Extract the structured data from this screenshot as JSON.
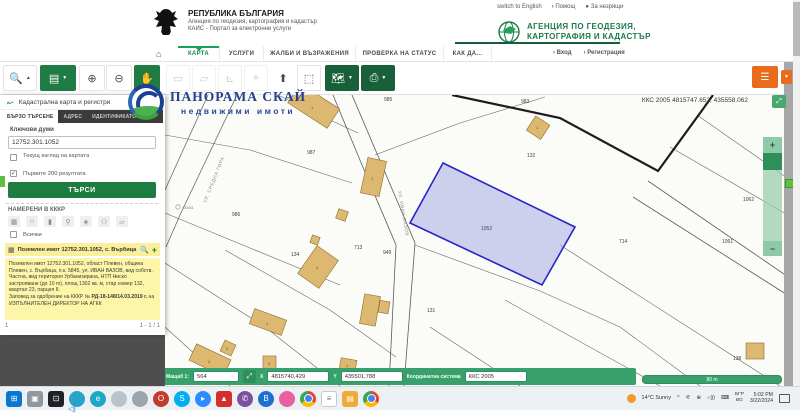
{
  "header": {
    "coat_title": "РЕПУБЛИКА БЪЛГАРИЯ",
    "coat_sub1": "Агенция по геодезия, картография и кадастър",
    "coat_sub2": "КАИС - Портал за електронни услуги",
    "top_links": {
      "english": "switch to English",
      "help": "Помощ",
      "blind": "За незрящи",
      "arrow": "›",
      "dot": "●"
    },
    "agency_line1": "АГЕНЦИЯ ПО ГЕОДЕЗИЯ,",
    "agency_line2": "КАРТОГРАФИЯ И КАДАСТЪР",
    "nav": [
      {
        "label": "КАРТА"
      },
      {
        "label": "УСЛУГИ"
      },
      {
        "label": "ЖАЛБИ И ВЪЗРАЖЕНИЯ"
      },
      {
        "label": "ПРОВЕРКА НА СТАТУС"
      },
      {
        "label": "КАК ДА..."
      }
    ],
    "auth": {
      "login": "Вход",
      "register": "Регистрация",
      "arrow": "›"
    }
  },
  "sidebar": {
    "panel_title": "Кадастрална карта и регистри",
    "tabs": [
      {
        "label": "БЪРЗО ТЪРСЕНЕ"
      },
      {
        "label": "АДРЕС"
      },
      {
        "label": "ИДЕНТИФИКАТОР"
      },
      {
        "label": "С"
      }
    ],
    "keywords_label": "Ключови думи",
    "search_value": "12752.301.1052",
    "cb_current_view": "Текущ изглед на картата",
    "cb_first_200": "Първите 200 резултата",
    "check_glyph": "✓",
    "search_button": "ТЪРСИ",
    "found_header": "НАМЕРЕНИ В КККР",
    "all_label": "Всички",
    "result_title": "Поземлен имот 12752.301.1052, с. Върбица",
    "result_plus": "+",
    "detail_text": "Поземлен имот 12752.301.1052, област Плевен, община Плевен, с. Върбица, п.к. 5845, ул. ИВАН ВАЗОВ, вид собств. Частна, вид територия Урбанизирана, НТП Ниско застрояване (до 10 m), площ 1302 кв. м, стар номер 132, квартал 23, парцел II.",
    "order_prefix": "Заповед за одобрение на КККР № ",
    "order_num": "РД-18-148/14.03.2019 г.",
    "order_suffix": " на ИЗПЪЛНИТЕЛЕН ДИРЕКТОР НА АГКК",
    "page_current": "1",
    "page_range": "1 - 1 / 1"
  },
  "map": {
    "coords_readout": "ККС 2005 4815747.652, 435558.062",
    "watermark_title": "ПАНОРАМА СКАЙ",
    "watermark_sub": "недвижими имоти",
    "scalebar_label": "80 m",
    "labels": [
      {
        "text": "985"
      },
      {
        "text": "983"
      },
      {
        "text": "987"
      },
      {
        "text": "132"
      },
      {
        "text": "986"
      },
      {
        "text": "1052"
      },
      {
        "text": "714"
      },
      {
        "text": "713"
      },
      {
        "text": "949"
      },
      {
        "text": "134"
      },
      {
        "text": "131"
      },
      {
        "text": "1063"
      },
      {
        "text": "1062"
      },
      {
        "text": "1061"
      },
      {
        "text": "138"
      },
      {
        "text": "135/51"
      }
    ],
    "building_labels": [
      {
        "text": "1"
      },
      {
        "text": "1"
      },
      {
        "text": "1"
      },
      {
        "text": "4"
      },
      {
        "text": "1"
      },
      {
        "text": "4"
      },
      {
        "text": "2"
      },
      {
        "text": "3"
      },
      {
        "text": "1"
      }
    ],
    "streets": [
      {
        "text": "УЛ. СРЕДНА ГОРА"
      },
      {
        "text": "УЛ. ИВАН ВАЗОВ"
      }
    ]
  },
  "statusbar": {
    "scale_label": "Мащаб  1:",
    "scale_value": "564",
    "x_label": "X",
    "x_value": "4815740,429",
    "y_label": "Y",
    "y_value": "435501,788",
    "crs_label": "Координатна система",
    "crs_value": "ККС 2005"
  },
  "taskbar": {
    "icons": [
      {
        "name": "start",
        "color": "#0b76d1",
        "glyph": "⊞",
        "kind": "sq"
      },
      {
        "name": "task-view",
        "color": "#8f989f",
        "glyph": "▣",
        "kind": "sq"
      },
      {
        "name": "teamviewer",
        "color": "#202124",
        "glyph": "⊡",
        "kind": "sq"
      },
      {
        "name": "browser-teal",
        "color": "#2aa3c9",
        "glyph": ""
      },
      {
        "name": "edge",
        "color": "#1ba9c7",
        "glyph": "e"
      },
      {
        "name": "feather-app",
        "color": "#b9c3c9",
        "glyph": ""
      },
      {
        "name": "grey-app",
        "color": "#9aa5ad",
        "glyph": ""
      },
      {
        "name": "opera",
        "color": "#c23b2e",
        "glyph": "O"
      },
      {
        "name": "skype",
        "color": "#00aff0",
        "glyph": "S"
      },
      {
        "name": "zoom",
        "color": "#2d8cff",
        "glyph": "▸"
      },
      {
        "name": "acrobat",
        "color": "#d32f2f",
        "glyph": "▲",
        "kind": "sq"
      },
      {
        "name": "viber",
        "color": "#7b519d",
        "glyph": "✆"
      },
      {
        "name": "battle-net",
        "color": "#1f6fd0",
        "glyph": "B"
      },
      {
        "name": "pink-app",
        "color": "#e85fa2",
        "glyph": ""
      },
      {
        "name": "chrome",
        "kind": "chrome",
        "glyph": ""
      },
      {
        "name": "notepad",
        "color": "#ffffff",
        "glyph": "≡",
        "kind": "sq"
      },
      {
        "name": "file-explorer",
        "color": "#f0a93a",
        "glyph": "▤",
        "kind": "sq"
      },
      {
        "name": "chrome-2",
        "kind": "chrome",
        "glyph": ""
      }
    ],
    "tray": {
      "weather": "14°C  Sunny",
      "chevron": "^",
      "net_glyph": "⚟",
      "pin_glyph": "⊕",
      "vol_glyph": "◁))",
      "kbd_glyph": "⌨",
      "lang1": "БГР",
      "lang2": "BG",
      "time": "5:02 PM",
      "date": "3/22/2024"
    }
  }
}
